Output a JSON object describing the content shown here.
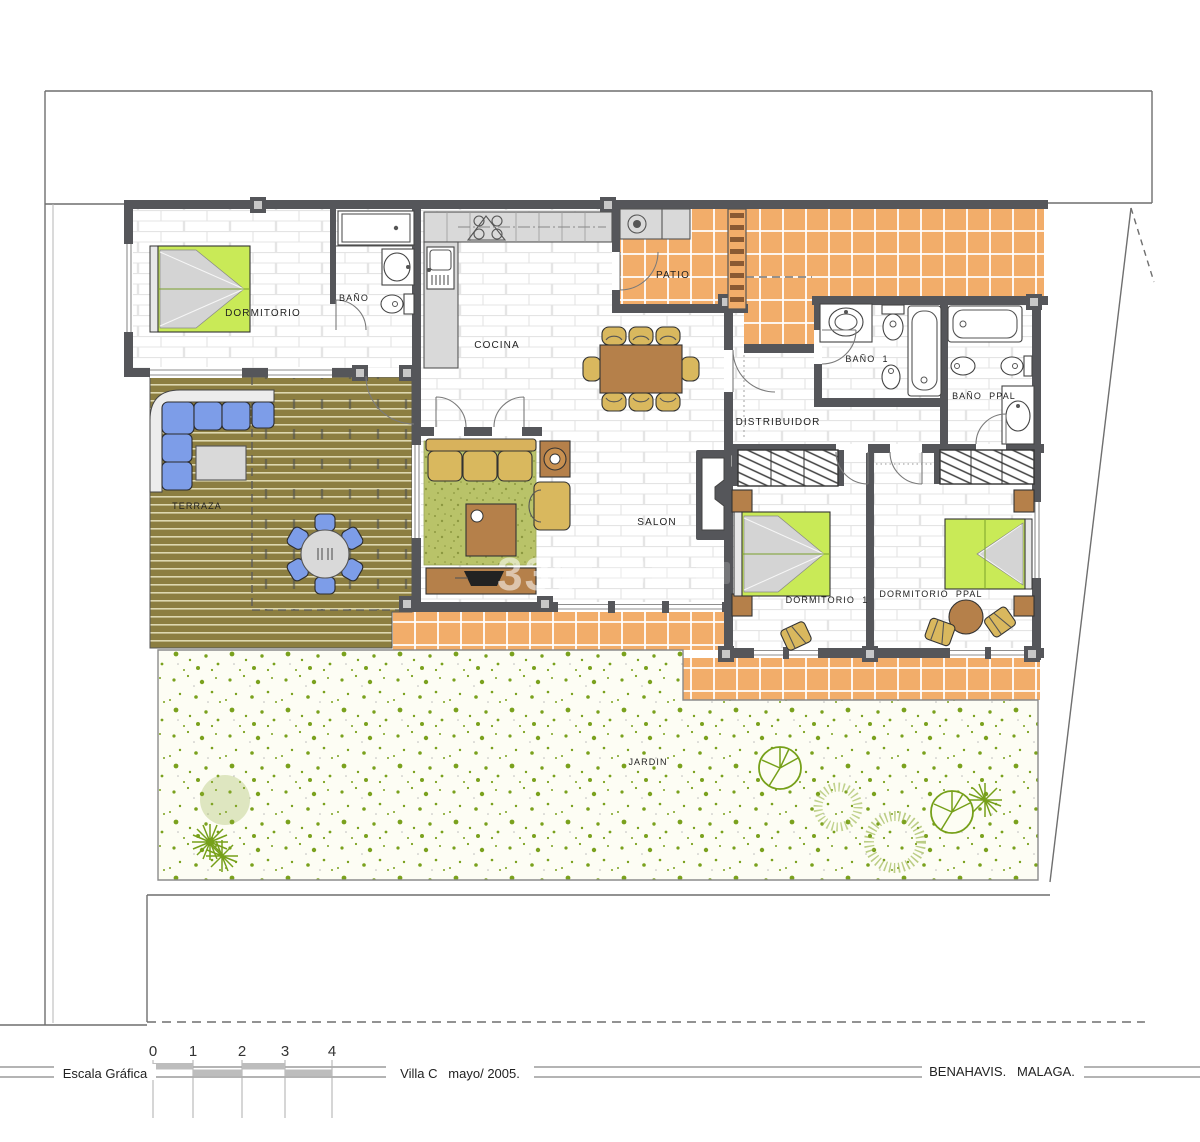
{
  "plan": {
    "rooms": {
      "dormitorio": "DORMITORIO",
      "bano": "BAÑO",
      "cocina": "COCINA",
      "patio": "PATIO",
      "bano1": "BAÑO  1",
      "bano_ppal": "BAÑO  PPAL",
      "distribuidor": "DISTRIBUIDOR",
      "salon": "SALON",
      "terraza": "TERRAZA",
      "dormitorio1": "DORMITORIO  1",
      "dormitorio_ppal": "DORMITORIO  PPAL",
      "jardin": "JARDIN"
    },
    "watermark": "336"
  },
  "titleblock": {
    "scale_label": "Escala Gráfica",
    "ticks": [
      "0",
      "1",
      "2",
      "3",
      "4"
    ],
    "project": "Villa C   mayo/ 2005.",
    "location": "BENAHAVIS.   MALAGA."
  },
  "colors": {
    "wall": "#55565a",
    "patio_tile": "#f2ad6a",
    "deck": "#8c7e41",
    "garden_dot": "#7aa11d",
    "bed_green": "#c9ea57",
    "outdoor_blue": "#7d9de8",
    "wood": "#b5804a",
    "chair_tan": "#d9b85e",
    "rug_green": "#b8c468",
    "counter_gray": "#d9d9d9"
  }
}
